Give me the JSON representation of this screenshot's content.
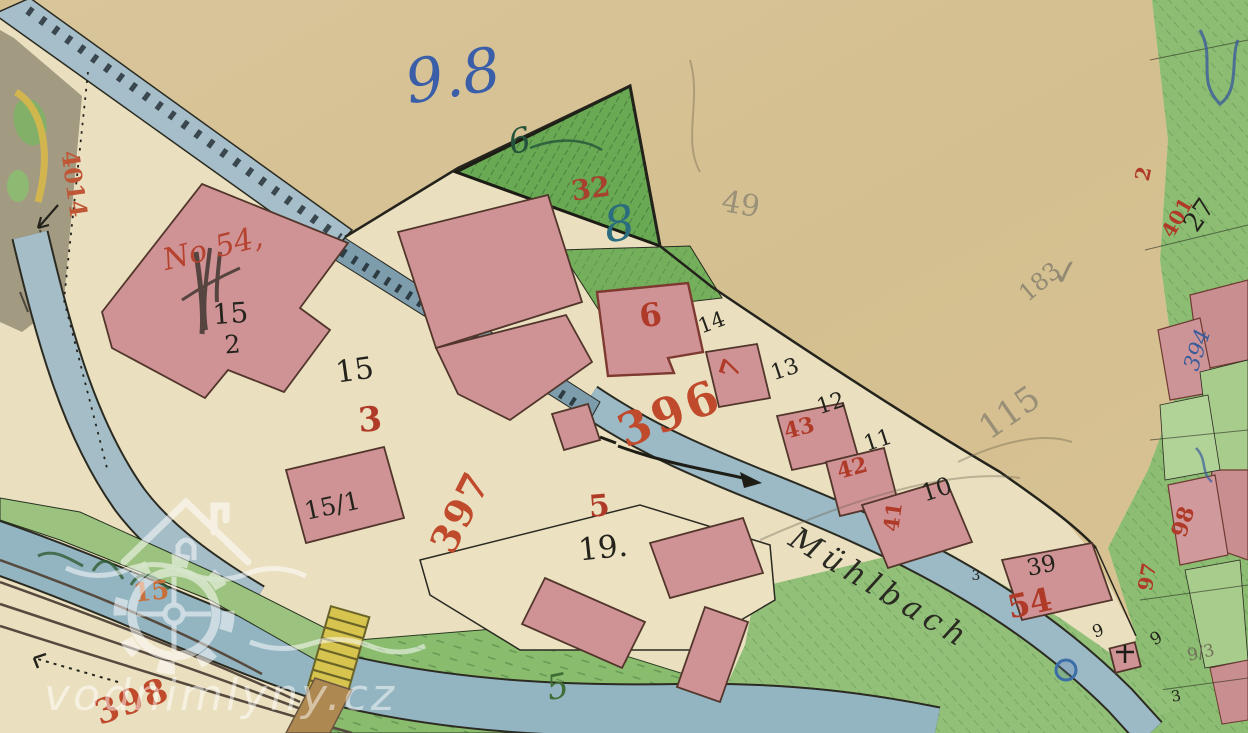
{
  "map": {
    "type": "historical cadastral map of a water-mill site",
    "stream_name": "Mühlbach",
    "watermark": {
      "text": "vodnimlyny.cz",
      "logo": "house-and-gear-icon"
    }
  },
  "colors": {
    "paper_tan": "#d6c193",
    "parcel_cream": "#eae0c0",
    "water_blue": "#9cb9c6",
    "race_blue": "#7e9dac",
    "building_pink": "#cf9396",
    "meadow_green": "#8cbd72",
    "triangle_green": "#69a953",
    "ink_red": "#b03a28",
    "ink_blue": "#3a5fa8",
    "ink_black": "#23231c",
    "pencil_grey": "#87816d",
    "bridge_yellow": "#d6c44e",
    "watermark_white": "#ffffff"
  },
  "labels": [
    {
      "name": "annotation-blue-9-8",
      "text": "9.8",
      "x": 456,
      "y": 96,
      "size": 60,
      "rot": -9,
      "color": "#3a5fa8",
      "italic": true
    },
    {
      "name": "parcel-number-6-triangle",
      "text": "6",
      "x": 522,
      "y": 152,
      "size": 34,
      "rot": -12,
      "color": "#24523a",
      "italic": true
    },
    {
      "name": "house-number-32",
      "text": "32",
      "x": 592,
      "y": 198,
      "size": 28,
      "rot": -8,
      "color": "#a8402e",
      "bold": true
    },
    {
      "name": "parcel-number-8",
      "text": "8",
      "x": 622,
      "y": 240,
      "size": 48,
      "rot": -10,
      "color": "#2b6d7f",
      "italic": true
    },
    {
      "name": "pencil-49",
      "text": "49",
      "x": 739,
      "y": 214,
      "size": 30,
      "rot": 10,
      "color": "#8d8672",
      "op": 0.8
    },
    {
      "name": "parcel-number-27",
      "text": "27",
      "x": 1206,
      "y": 220,
      "size": 26,
      "rot": -55,
      "color": "#23231c"
    },
    {
      "name": "house-number-2-red",
      "text": "2",
      "x": 1150,
      "y": 175,
      "size": 20,
      "rot": -78,
      "color": "#b03a28",
      "bold": true
    },
    {
      "name": "house-number-401",
      "text": "401",
      "x": 1183,
      "y": 221,
      "size": 20,
      "rot": -60,
      "color": "#b03a28",
      "bold": true
    },
    {
      "name": "road-number-4014",
      "text": "4014",
      "x": 66,
      "y": 185,
      "size": 24,
      "rot": 82,
      "color": "#bf5636",
      "bold": true
    },
    {
      "name": "house-name-no54",
      "text": "No 54,",
      "x": 215,
      "y": 258,
      "size": 30,
      "rot": -14,
      "color": "#b5432f",
      "italic": true
    },
    {
      "name": "building-15-2-top",
      "text": "15",
      "x": 231,
      "y": 323,
      "size": 28,
      "rot": -4,
      "color": "#23231c"
    },
    {
      "name": "building-15-2-bottom",
      "text": "2",
      "x": 233,
      "y": 353,
      "size": 25,
      "rot": -4,
      "color": "#23231c"
    },
    {
      "name": "parcel-number-15",
      "text": "15",
      "x": 356,
      "y": 380,
      "size": 30,
      "rot": -8,
      "color": "#23231c"
    },
    {
      "name": "house-number-3",
      "text": "3",
      "x": 371,
      "y": 431,
      "size": 34,
      "rot": -5,
      "color": "#b03a28",
      "bold": true
    },
    {
      "name": "building-15-1-label",
      "text": "15/1",
      "x": 334,
      "y": 514,
      "size": 25,
      "rot": -12,
      "color": "#23231c"
    },
    {
      "name": "house-number-6",
      "text": "6",
      "x": 652,
      "y": 326,
      "size": 32,
      "rot": -8,
      "color": "#b03a28",
      "bold": true
    },
    {
      "name": "parcel-number-14",
      "text": "14",
      "x": 714,
      "y": 329,
      "size": 21,
      "rot": -20,
      "color": "#23231c"
    },
    {
      "name": "house-number-7",
      "text": "7",
      "x": 739,
      "y": 371,
      "size": 26,
      "rot": -72,
      "color": "#b03a28",
      "bold": true
    },
    {
      "name": "parcel-number-13",
      "text": "13",
      "x": 787,
      "y": 376,
      "size": 22,
      "rot": -18,
      "color": "#23231c"
    },
    {
      "name": "parcel-number-12",
      "text": "12",
      "x": 833,
      "y": 410,
      "size": 22,
      "rot": -18,
      "color": "#23231c"
    },
    {
      "name": "house-number-43",
      "text": "43",
      "x": 801,
      "y": 435,
      "size": 22,
      "rot": -15,
      "color": "#b03a28",
      "bold": true
    },
    {
      "name": "parcel-number-11",
      "text": "11",
      "x": 880,
      "y": 447,
      "size": 22,
      "rot": -18,
      "color": "#23231c"
    },
    {
      "name": "house-number-42",
      "text": "42",
      "x": 854,
      "y": 475,
      "size": 22,
      "rot": -15,
      "color": "#b03a28",
      "bold": true
    },
    {
      "name": "parcel-number-10",
      "text": "10",
      "x": 939,
      "y": 497,
      "size": 24,
      "rot": -18,
      "color": "#23231c"
    },
    {
      "name": "house-number-41",
      "text": "41",
      "x": 900,
      "y": 518,
      "size": 21,
      "rot": -82,
      "color": "#b03a28",
      "bold": true
    },
    {
      "name": "road-number-396",
      "text": "396",
      "x": 676,
      "y": 428,
      "size": 46,
      "rot": -22,
      "color": "#bf4a2c",
      "bold": true,
      "ls": 4
    },
    {
      "name": "road-number-397",
      "text": "397",
      "x": 472,
      "y": 518,
      "size": 38,
      "rot": -63,
      "color": "#bf4a2c",
      "bold": true,
      "ls": 2
    },
    {
      "name": "road-number-398",
      "text": "398",
      "x": 136,
      "y": 712,
      "size": 34,
      "rot": -20,
      "color": "#bf4a2c",
      "bold": true,
      "ls": 2
    },
    {
      "name": "house-number-5",
      "text": "5",
      "x": 600,
      "y": 516,
      "size": 30,
      "rot": -5,
      "color": "#b03a28",
      "bold": true
    },
    {
      "name": "parcel-number-19",
      "text": "19.",
      "x": 604,
      "y": 558,
      "size": 31,
      "rot": -6,
      "color": "#23231c"
    },
    {
      "name": "stream-name",
      "text": "Mühlbach",
      "x": 875,
      "y": 597,
      "size": 31,
      "rot": 31,
      "color": "#2a2a22",
      "italic": true,
      "ls": 6
    },
    {
      "name": "parcel-number-5-green",
      "text": "5",
      "x": 560,
      "y": 698,
      "size": 34,
      "rot": -12,
      "color": "#3f6d35",
      "italic": true
    },
    {
      "name": "parcel-number-15-orange",
      "text": "15",
      "x": 152,
      "y": 600,
      "size": 26,
      "rot": -6,
      "color": "#c8703c",
      "bold": true
    },
    {
      "name": "parcel-number-39",
      "text": "39",
      "x": 1043,
      "y": 573,
      "size": 23,
      "rot": -12,
      "color": "#23231c"
    },
    {
      "name": "house-number-54",
      "text": "54",
      "x": 1032,
      "y": 614,
      "size": 32,
      "rot": -12,
      "color": "#b03a28",
      "bold": true
    },
    {
      "name": "pencil-183",
      "text": "183",
      "x": 1045,
      "y": 288,
      "size": 24,
      "rot": -40,
      "color": "#87816d",
      "op": 0.85
    },
    {
      "name": "pencil-checkmark",
      "text": "✓",
      "x": 1068,
      "y": 284,
      "size": 34,
      "rot": -10,
      "color": "#87816d",
      "op": 0.85
    },
    {
      "name": "pencil-115",
      "text": "115",
      "x": 1016,
      "y": 422,
      "size": 34,
      "rot": -35,
      "color": "#8a8471",
      "op": 0.8
    },
    {
      "name": "parcel-number-394",
      "text": "394",
      "x": 1204,
      "y": 352,
      "size": 22,
      "rot": -72,
      "color": "#3b5d9c",
      "italic": true
    },
    {
      "name": "parcel-number-98",
      "text": "98",
      "x": 1190,
      "y": 524,
      "size": 22,
      "rot": -72,
      "color": "#b03a28",
      "bold": true
    },
    {
      "name": "parcel-number-97",
      "text": "97",
      "x": 1154,
      "y": 578,
      "size": 20,
      "rot": -80,
      "color": "#b03a28",
      "bold": true
    },
    {
      "name": "parcel-number-9-a",
      "text": "9",
      "x": 1100,
      "y": 636,
      "size": 17,
      "rot": -20,
      "color": "#23231c"
    },
    {
      "name": "parcel-number-9-b",
      "text": "9",
      "x": 1159,
      "y": 643,
      "size": 17,
      "rot": -30,
      "color": "#23231c"
    },
    {
      "name": "pencil-9-3",
      "text": "9/3",
      "x": 1202,
      "y": 658,
      "size": 17,
      "rot": -12,
      "color": "#6e6856",
      "op": 0.9
    },
    {
      "name": "parcel-number-3-a",
      "text": "3",
      "x": 976,
      "y": 580,
      "size": 14,
      "rot": 0,
      "color": "#23231c"
    },
    {
      "name": "parcel-number-3-b",
      "text": "3",
      "x": 1177,
      "y": 701,
      "size": 15,
      "rot": -10,
      "color": "#23231c"
    }
  ]
}
